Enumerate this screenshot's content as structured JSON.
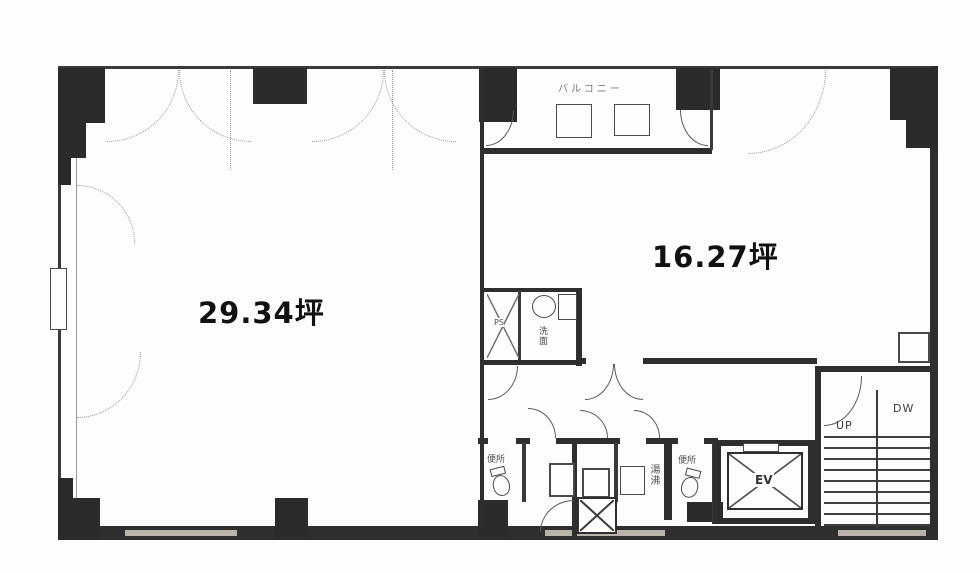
{
  "plan": {
    "title": "floor-plan",
    "labels": {
      "left_room_area": "29.34坪",
      "right_room_area": "16.27坪",
      "balcony": "バルコニー",
      "pipe_shaft": "PS",
      "washbasin": "洗面",
      "toilet_left": "便所",
      "toilet_right": "便所",
      "water_heater": "湯沸",
      "elevator": "EV",
      "stairs_up": "UP",
      "stairs_down": "DW"
    },
    "colors": {
      "paper": "#fdfdfb",
      "ink": "#1f1f1f",
      "wall_fill": "#2e2e2e",
      "thin_line": "#5a5a5a",
      "dotted_line": "#979790",
      "window_segment": "#b8b3ab"
    }
  }
}
